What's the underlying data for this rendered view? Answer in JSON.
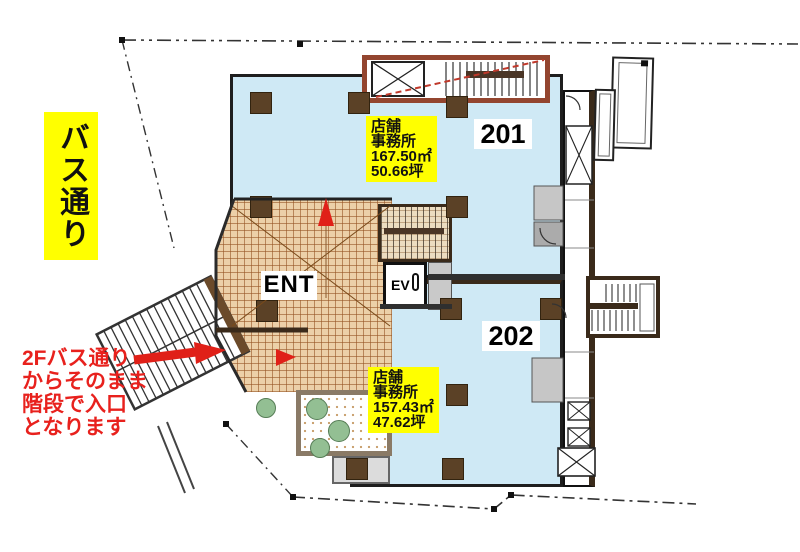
{
  "street_label": {
    "text": "バス通り"
  },
  "note": {
    "lines": [
      "2Fバス通り",
      "からそのまま",
      "階段で入口",
      "となります"
    ]
  },
  "units": [
    {
      "number": "201",
      "label_lines": [
        "店舗",
        "事務所",
        "167.50㎡",
        "50.66坪"
      ]
    },
    {
      "number": "202",
      "label_lines": [
        "店舗",
        "事務所",
        "157.43㎡",
        "47.62坪"
      ]
    }
  ],
  "entrance": {
    "label": "ENT"
  },
  "elevator": {
    "label": "EV"
  },
  "colors": {
    "floor_blue": "#cfe9f5",
    "tile_tan": "#ecd0a8",
    "wall_brown": "#3a2a1a",
    "column_brown": "#5b4126",
    "stair_wall_red": "#93452f",
    "highlight_yellow": "#ffff00",
    "note_red": "#e8211d",
    "arrow_red": "#e02018"
  }
}
